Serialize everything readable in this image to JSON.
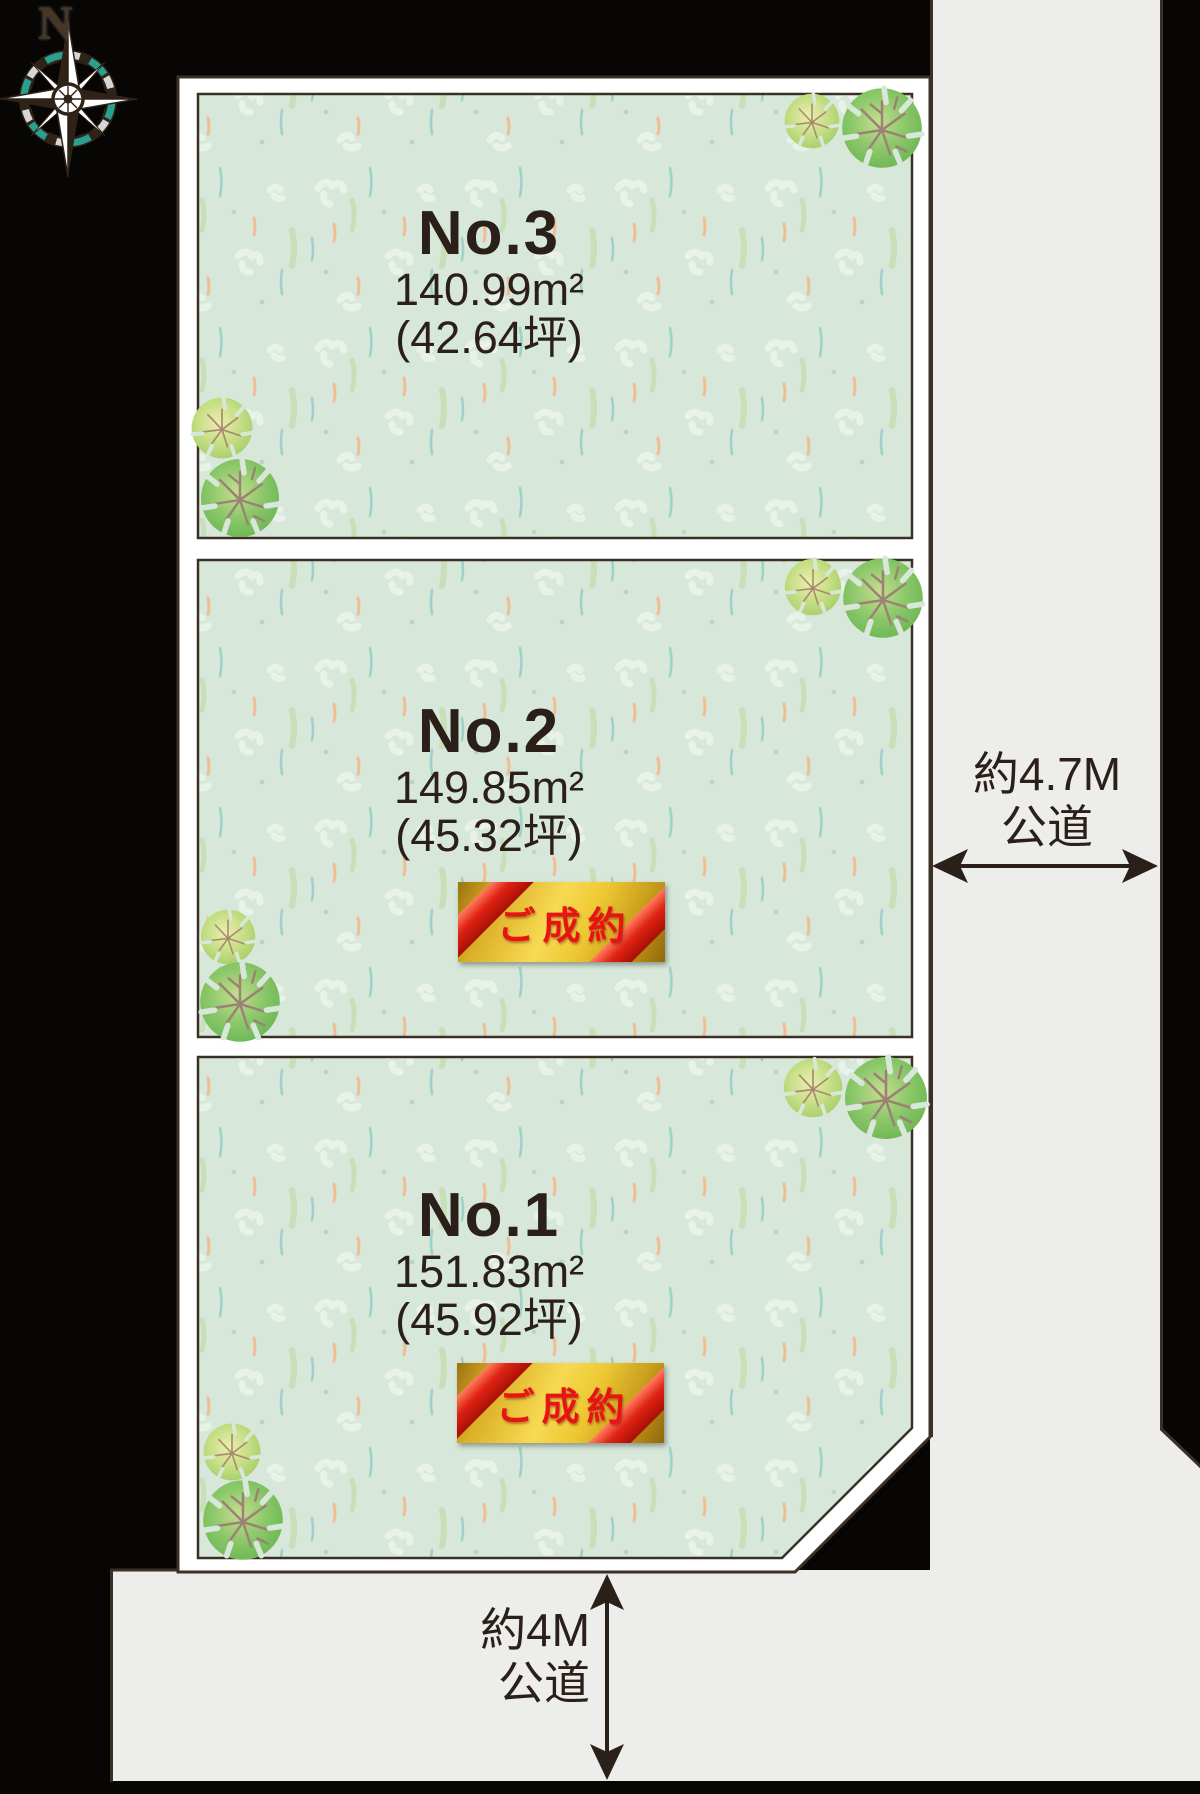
{
  "diagram": {
    "compass": {
      "north_label": "N"
    },
    "lots": [
      {
        "name": "No.3",
        "area_m2": "140.99m²",
        "area_tsubo": "(42.64坪)",
        "status": ""
      },
      {
        "name": "No.2",
        "area_m2": "149.85m²",
        "area_tsubo": "(45.32坪)",
        "status": "ご成約"
      },
      {
        "name": "No.1",
        "area_m2": "151.83m²",
        "area_tsubo": "(45.92坪)",
        "status": "ご成約"
      }
    ],
    "roads": {
      "east": {
        "width_label": "約4.7M",
        "type_label": "公道"
      },
      "south": {
        "width_label": "約4M",
        "type_label": "公道"
      }
    },
    "colors": {
      "background": "#070605",
      "lot_fill": "#d7e8da",
      "road_fill": "#ededeb",
      "outline": "#3a3026",
      "banner_gold": "#e7bd2a",
      "banner_ribbon": "#e02313",
      "banner_text": "#e81414",
      "tree_green": "#5fae49",
      "compass_teal": "#2aa08e"
    }
  }
}
